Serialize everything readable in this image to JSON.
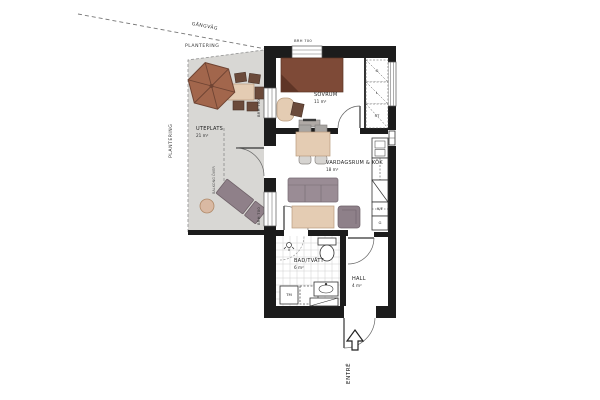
{
  "site": {
    "walkway": "GÅNGVÄG",
    "planting_top": "PLANTERING",
    "planting_left": "PLANTERING",
    "entry": "ENTRÉ"
  },
  "patio": {
    "name": "UTEPLATS",
    "area": "21 m²",
    "note": "BALKONG ÖVER"
  },
  "rooms": {
    "bedroom": {
      "name": "SOVRUM",
      "area": "11 m²"
    },
    "living": {
      "name": "VARDAGSRUM & KÖK",
      "area": "18 m²"
    },
    "bath": {
      "name": "BAD/TVÄTT",
      "area": "6 m²"
    },
    "hall": {
      "name": "HALL",
      "area": "4 m²"
    }
  },
  "labels": {
    "sill_height": "BRH 700",
    "fridge_freezer": "K/F",
    "wardrobe": "G",
    "washer": "TM",
    "closet_1": "G",
    "closet_2": "L",
    "closet_3": "ST"
  },
  "colors": {
    "wall": "#1c1c1c",
    "patio": "#d8d7d4",
    "wood": "#e4ccb3",
    "woodLine": "#b99b7d",
    "bed": "#7e4a37",
    "bedDark": "#5f3526",
    "sofa": "#9a8c95",
    "sofaLine": "#766a72",
    "armchair": "#8e8089",
    "lounger": "#8f8089",
    "parasol": "#a2664c",
    "parasolRib": "#6f4433",
    "chairDark": "#6b4a3a",
    "grayChair": "#a8a5a2",
    "line": "#444444",
    "tileLine": "#cfcfcf"
  }
}
